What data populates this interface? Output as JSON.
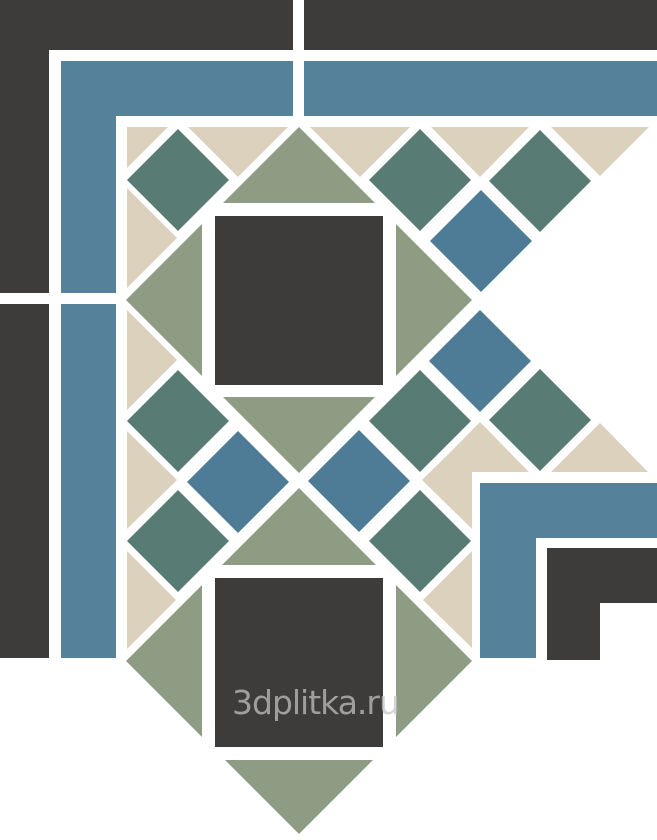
{
  "image": {
    "width": 657,
    "height": 840,
    "subject": "ceramic-mosaic-corner-tile-pattern"
  },
  "watermark": {
    "text": "3dplitka.ru",
    "color": "#c4c4c4",
    "opacity": 0.72,
    "font_size": 33,
    "x": 232,
    "baseline_y": 714
  },
  "colors": {
    "background": "#ffffff",
    "grout": "#ffffff",
    "dark": "#3e3c3a",
    "blue_band": "#56819b",
    "blue_diamond": "#4e7c97",
    "teal": "#587b74",
    "sage": "#8e9c84",
    "beige": "#dbd1bc"
  },
  "pattern": {
    "small_diamond_half": 51,
    "big_diamond_half": 173,
    "shapes": [
      {
        "name": "outer-dark-corner-L",
        "color": "dark",
        "type": "polygon",
        "points": [
          [
            0,
            0
          ],
          [
            293,
            0
          ],
          [
            293,
            50
          ],
          [
            49,
            50
          ],
          [
            49,
            293
          ],
          [
            0,
            293
          ]
        ]
      },
      {
        "name": "outer-dark-top-strip",
        "color": "dark",
        "type": "rect",
        "x": 304,
        "y": 0,
        "w": 353,
        "h": 50
      },
      {
        "name": "outer-dark-left-strip",
        "color": "dark",
        "type": "rect",
        "x": 0,
        "y": 304,
        "w": 49,
        "h": 354
      },
      {
        "name": "outer-blue-corner-L",
        "color": "blue_band",
        "type": "polygon",
        "points": [
          [
            61,
            61
          ],
          [
            293,
            61
          ],
          [
            293,
            116
          ],
          [
            116,
            116
          ],
          [
            116,
            293
          ],
          [
            61,
            293
          ]
        ]
      },
      {
        "name": "outer-blue-top-strip",
        "color": "blue_band",
        "type": "rect",
        "x": 304,
        "y": 61,
        "w": 353,
        "h": 55
      },
      {
        "name": "outer-blue-left-strip",
        "color": "blue_band",
        "type": "rect",
        "x": 61,
        "y": 304,
        "w": 55,
        "h": 354
      },
      {
        "name": "inner-blue-corner-L",
        "color": "blue_band",
        "type": "polygon",
        "points": [
          [
            480,
            483
          ],
          [
            657,
            483
          ],
          [
            657,
            538
          ],
          [
            536,
            538
          ],
          [
            536,
            658
          ],
          [
            480,
            658
          ]
        ]
      },
      {
        "name": "inner-dark-step",
        "color": "dark",
        "type": "polygon",
        "points": [
          [
            547,
            548
          ],
          [
            657,
            548
          ],
          [
            657,
            603
          ],
          [
            600,
            603
          ],
          [
            600,
            660
          ],
          [
            547,
            660
          ]
        ]
      },
      {
        "name": "big-sage-diamond-1",
        "color": "sage",
        "type": "diamond",
        "cx": 299,
        "cy": 300,
        "h": 173
      },
      {
        "name": "frame-square-1",
        "color": "grout",
        "type": "rect",
        "x": 202,
        "y": 203,
        "w": 194,
        "h": 194
      },
      {
        "name": "dark-center-square-1",
        "color": "dark",
        "type": "rect",
        "x": 215,
        "y": 216,
        "w": 168,
        "h": 169
      },
      {
        "name": "big-sage-diamond-2",
        "color": "sage",
        "type": "diamond",
        "cx": 299,
        "cy": 661,
        "h": 173
      },
      {
        "name": "frame-square-2",
        "color": "grout",
        "type": "rect",
        "x": 202,
        "y": 565,
        "w": 194,
        "h": 195
      },
      {
        "name": "dark-center-square-2",
        "color": "dark",
        "type": "rect",
        "x": 215,
        "y": 578,
        "w": 168,
        "h": 169
      },
      {
        "name": "teal-diamond-corner",
        "color": "teal",
        "type": "diamond",
        "cx": 178,
        "cy": 180
      },
      {
        "name": "teal-diamond-top-1",
        "color": "teal",
        "type": "diamond",
        "cx": 420,
        "cy": 180
      },
      {
        "name": "teal-diamond-top-2",
        "color": "teal",
        "type": "diamond",
        "cx": 540,
        "cy": 181
      },
      {
        "name": "teal-diamond-left-1",
        "color": "teal",
        "type": "diamond",
        "cx": 178,
        "cy": 421
      },
      {
        "name": "teal-diamond-inner-x",
        "color": "teal",
        "type": "diamond",
        "cx": 420,
        "cy": 421
      },
      {
        "name": "teal-diamond-inner-top",
        "color": "teal",
        "type": "diamond",
        "cx": 540,
        "cy": 420
      },
      {
        "name": "teal-diamond-left-2",
        "color": "teal",
        "type": "diamond",
        "cx": 178,
        "cy": 541
      },
      {
        "name": "teal-diamond-inner-left",
        "color": "teal",
        "type": "diamond",
        "cx": 420,
        "cy": 541
      },
      {
        "name": "blue-diamond-top-outer",
        "color": "blue_diamond",
        "type": "diamond",
        "cx": 481,
        "cy": 241
      },
      {
        "name": "blue-diamond-top-inner",
        "color": "blue_diamond",
        "type": "diamond",
        "cx": 480,
        "cy": 361
      },
      {
        "name": "blue-diamond-left-inner",
        "color": "blue_diamond",
        "type": "diamond",
        "cx": 238,
        "cy": 482
      },
      {
        "name": "blue-diamond-center",
        "color": "blue_diamond",
        "type": "diamond",
        "cx": 359,
        "cy": 481
      },
      {
        "name": "beige-corner-triangle",
        "color": "beige",
        "type": "polygon",
        "points": [
          [
            127,
            127
          ],
          [
            168,
            127
          ],
          [
            127,
            168
          ]
        ]
      },
      {
        "name": "beige-top-triangle-1",
        "color": "beige",
        "type": "polygon",
        "points": [
          [
            188,
            127
          ],
          [
            288,
            127
          ],
          [
            238,
            177
          ]
        ]
      },
      {
        "name": "beige-top-triangle-2",
        "color": "beige",
        "type": "polygon",
        "points": [
          [
            310,
            127
          ],
          [
            410,
            127
          ],
          [
            360,
            177
          ]
        ]
      },
      {
        "name": "beige-top-triangle-3",
        "color": "beige",
        "type": "polygon",
        "points": [
          [
            431,
            127
          ],
          [
            529,
            127
          ],
          [
            480,
            177
          ]
        ]
      },
      {
        "name": "beige-top-triangle-4",
        "color": "beige",
        "type": "polygon",
        "points": [
          [
            551,
            127
          ],
          [
            649,
            127
          ],
          [
            600,
            176
          ]
        ]
      },
      {
        "name": "beige-left-triangle-1",
        "color": "beige",
        "type": "polygon",
        "points": [
          [
            127,
            188
          ],
          [
            127,
            288
          ],
          [
            177,
            238
          ]
        ]
      },
      {
        "name": "beige-left-triangle-2",
        "color": "beige",
        "type": "polygon",
        "points": [
          [
            127,
            310
          ],
          [
            127,
            410
          ],
          [
            177,
            360
          ]
        ]
      },
      {
        "name": "beige-left-triangle-3",
        "color": "beige",
        "type": "polygon",
        "points": [
          [
            127,
            431
          ],
          [
            127,
            529
          ],
          [
            177,
            480
          ]
        ]
      },
      {
        "name": "beige-left-triangle-4",
        "color": "beige",
        "type": "polygon",
        "points": [
          [
            127,
            551
          ],
          [
            127,
            649
          ],
          [
            176,
            600
          ]
        ]
      },
      {
        "name": "beige-inner-top-triangle-1",
        "color": "beige",
        "type": "polygon",
        "points": [
          [
            431,
            472
          ],
          [
            529,
            472
          ],
          [
            480,
            422
          ]
        ]
      },
      {
        "name": "beige-inner-top-triangle-2",
        "color": "beige",
        "type": "polygon",
        "points": [
          [
            551,
            472
          ],
          [
            648,
            472
          ],
          [
            600,
            423
          ]
        ]
      },
      {
        "name": "beige-inner-left-triangle-1",
        "color": "beige",
        "type": "polygon",
        "points": [
          [
            472,
            431
          ],
          [
            472,
            529
          ],
          [
            422,
            480
          ]
        ]
      },
      {
        "name": "beige-inner-left-triangle-2",
        "color": "beige",
        "type": "polygon",
        "points": [
          [
            472,
            551
          ],
          [
            472,
            648
          ],
          [
            423,
            600
          ]
        ]
      }
    ]
  }
}
